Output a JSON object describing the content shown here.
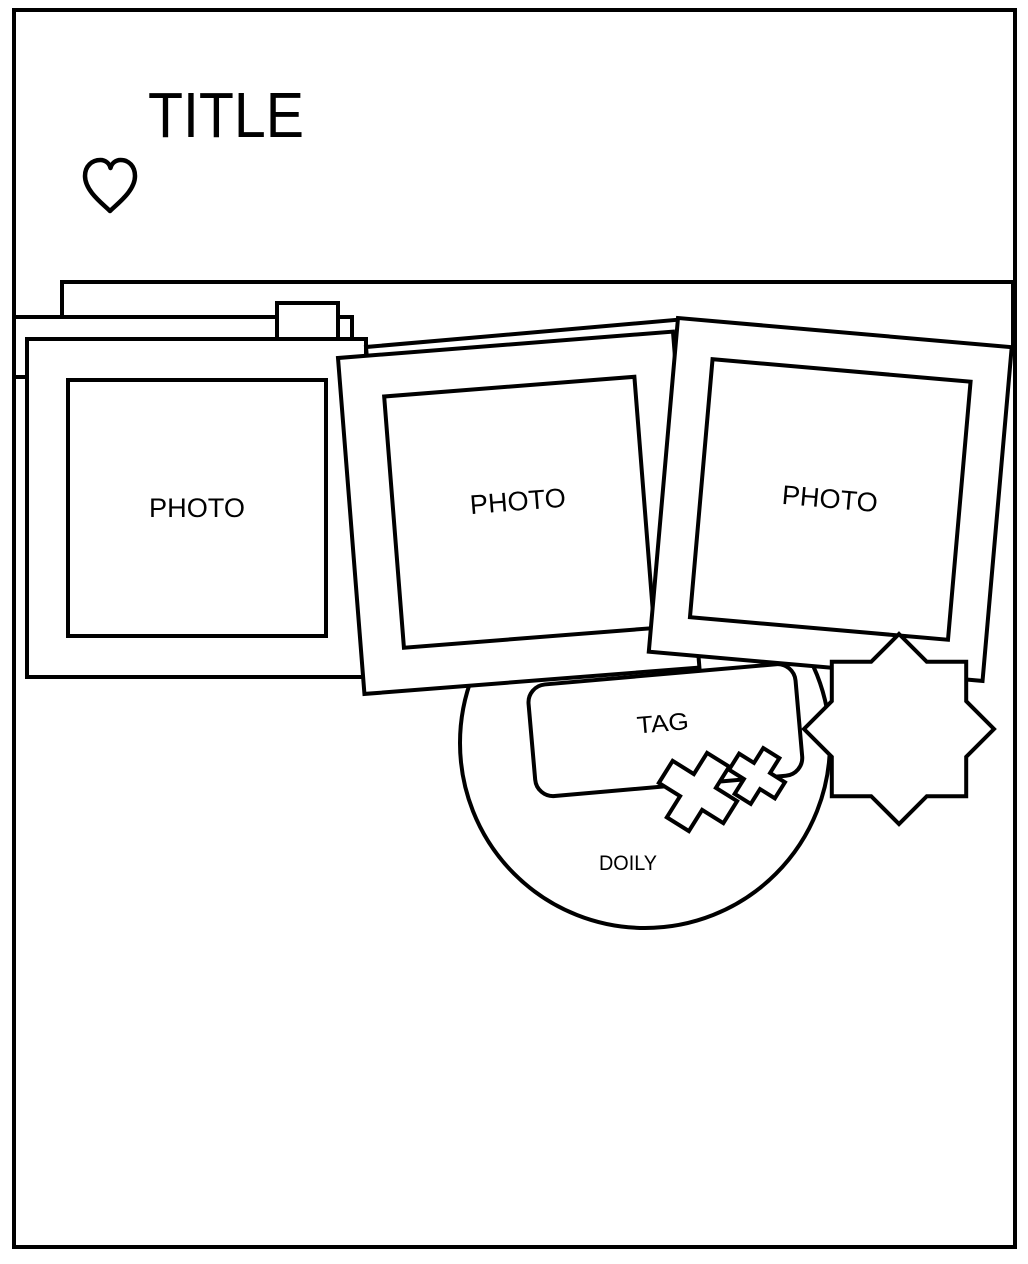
{
  "colors": {
    "ink": "#000000",
    "paper": "#ffffff"
  },
  "title": {
    "label": "TITLE"
  },
  "photos": [
    {
      "label": "PHOTO"
    },
    {
      "label": "PHOTO"
    },
    {
      "label": "PHOTO"
    }
  ],
  "tag": {
    "label": "TAG"
  },
  "doily": {
    "label": "DOILY"
  },
  "icons": {
    "heart": "heart-outline-icon",
    "star": "eight-point-star-icon",
    "stitches": "cross-stitch-icons"
  }
}
